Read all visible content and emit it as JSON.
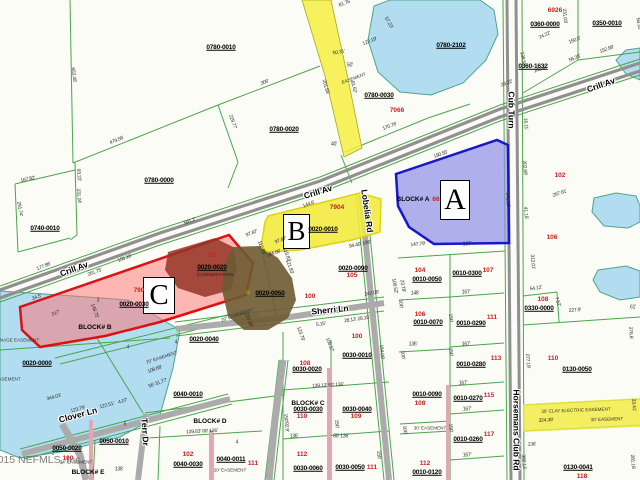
{
  "map": {
    "watermark": "©2015 NEFMLS, Inc",
    "regions": [
      {
        "letter": "A",
        "fill": "#8f8fe8",
        "border": "#1717cc"
      },
      {
        "letter": "B",
        "fill": "#f1ea3c",
        "border": "#ddd312"
      },
      {
        "letter": "C",
        "fill": "#ff7070",
        "border": "#dd1111"
      }
    ],
    "labels": {
      "parcels": [
        {
          "t": "0780-0010",
          "x": 221,
          "y": 48
        },
        {
          "t": "0780-0020",
          "x": 284,
          "y": 130
        },
        {
          "t": "0780-0000",
          "x": 159,
          "y": 181
        },
        {
          "t": "0740-0010",
          "x": 45,
          "y": 229
        },
        {
          "t": "0780-2102",
          "x": 451,
          "y": 46
        },
        {
          "t": "0360-0000",
          "x": 545,
          "y": 25
        },
        {
          "t": "0350-0010",
          "x": 607,
          "y": 24
        },
        {
          "t": "0360-1632",
          "x": 533,
          "y": 67
        },
        {
          "t": "0780-0030",
          "x": 379,
          "y": 96
        },
        {
          "t": "0020-0010",
          "x": 323,
          "y": 230
        },
        {
          "t": "0020-0020",
          "x": 212,
          "y": 268
        },
        {
          "t": "0020-0030",
          "x": 134,
          "y": 305
        },
        {
          "t": "0020-0040",
          "x": 204,
          "y": 340
        },
        {
          "t": "0020-0050",
          "x": 270,
          "y": 294
        },
        {
          "t": "0020-0090",
          "x": 353,
          "y": 269
        },
        {
          "t": "0020-0000",
          "x": 37,
          "y": 364
        },
        {
          "t": "0010-0050",
          "x": 427,
          "y": 280
        },
        {
          "t": "0010-0300",
          "x": 467,
          "y": 274
        },
        {
          "t": "0010-0070",
          "x": 428,
          "y": 323
        },
        {
          "t": "0010-0290",
          "x": 471,
          "y": 324
        },
        {
          "t": "0010-0280",
          "x": 471,
          "y": 365
        },
        {
          "t": "0010-0270",
          "x": 468,
          "y": 399
        },
        {
          "t": "0010-0090",
          "x": 427,
          "y": 395
        },
        {
          "t": "0010-0260",
          "x": 468,
          "y": 440
        },
        {
          "t": "0010-0120",
          "x": 427,
          "y": 473
        },
        {
          "t": "0130-0050",
          "x": 577,
          "y": 370
        },
        {
          "t": "0130-0041",
          "x": 578,
          "y": 468
        },
        {
          "t": "0330-0000",
          "x": 539,
          "y": 309
        },
        {
          "t": "0030-0010",
          "x": 357,
          "y": 356
        },
        {
          "t": "0030-0020",
          "x": 307,
          "y": 370
        },
        {
          "t": "0030-0030",
          "x": 308,
          "y": 410
        },
        {
          "t": "0030-0040",
          "x": 357,
          "y": 410
        },
        {
          "t": "0030-0060",
          "x": 308,
          "y": 469
        },
        {
          "t": "0030-0050",
          "x": 350,
          "y": 468
        },
        {
          "t": "0040-0010",
          "x": 188,
          "y": 395
        },
        {
          "t": "0040-0030",
          "x": 188,
          "y": 465
        },
        {
          "t": "0040-0011",
          "x": 231,
          "y": 460
        },
        {
          "t": "0050-0020",
          "x": 67,
          "y": 449
        },
        {
          "t": "0050-0010",
          "x": 114,
          "y": 442
        }
      ],
      "lot_numbers": [
        {
          "t": "6926",
          "x": 555,
          "y": 11
        },
        {
          "t": "7066",
          "x": 397,
          "y": 111
        },
        {
          "t": "7904",
          "x": 337,
          "y": 208
        },
        {
          "t": "790",
          "x": 139,
          "y": 291
        },
        {
          "t": "50",
          "x": 212,
          "y": 256
        },
        {
          "t": "66",
          "x": 436,
          "y": 200
        },
        {
          "t": "102",
          "x": 560,
          "y": 176
        },
        {
          "t": "106",
          "x": 552,
          "y": 238
        },
        {
          "t": "104",
          "x": 420,
          "y": 271
        },
        {
          "t": "107",
          "x": 488,
          "y": 271
        },
        {
          "t": "105",
          "x": 352,
          "y": 276
        },
        {
          "t": "100",
          "x": 310,
          "y": 297
        },
        {
          "t": "100",
          "x": 357,
          "y": 337
        },
        {
          "t": "108",
          "x": 305,
          "y": 364
        },
        {
          "t": "106",
          "x": 420,
          "y": 315
        },
        {
          "t": "111",
          "x": 492,
          "y": 318
        },
        {
          "t": "113",
          "x": 496,
          "y": 359
        },
        {
          "t": "110",
          "x": 553,
          "y": 359
        },
        {
          "t": "108",
          "x": 543,
          "y": 300
        },
        {
          "t": "115",
          "x": 489,
          "y": 396
        },
        {
          "t": "108",
          "x": 420,
          "y": 404
        },
        {
          "t": "117",
          "x": 489,
          "y": 435
        },
        {
          "t": "112",
          "x": 425,
          "y": 464
        },
        {
          "t": "118",
          "x": 582,
          "y": 477
        },
        {
          "t": "110",
          "x": 302,
          "y": 417
        },
        {
          "t": "109",
          "x": 356,
          "y": 417
        },
        {
          "t": "112",
          "x": 302,
          "y": 455
        },
        {
          "t": "111",
          "x": 372,
          "y": 468
        },
        {
          "t": "102",
          "x": 188,
          "y": 455
        },
        {
          "t": "111",
          "x": 253,
          "y": 464
        },
        {
          "t": "100",
          "x": 68,
          "y": 459
        }
      ],
      "roads": [
        {
          "t": "Crill Av",
          "x": 74,
          "y": 269,
          "r": -20
        },
        {
          "t": "Crill Av",
          "x": 318,
          "y": 192,
          "r": -17
        },
        {
          "t": "Crill Av",
          "x": 601,
          "y": 85,
          "r": -19
        },
        {
          "t": "Cub Turn",
          "x": 511,
          "y": 110,
          "r": 90
        },
        {
          "t": "Horsemans Club Rd",
          "x": 516,
          "y": 430,
          "r": 90
        },
        {
          "t": "Lobelia Rd",
          "x": 367,
          "y": 211,
          "r": 82
        },
        {
          "t": "Sherri Ln",
          "x": 330,
          "y": 310,
          "r": -6
        },
        {
          "t": "Clover Ln",
          "x": 78,
          "y": 415,
          "r": -15
        },
        {
          "t": "Terr Dr",
          "x": 145,
          "y": 432,
          "r": 87
        }
      ],
      "blocks": [
        {
          "t": "BLOCK# A",
          "x": 413,
          "y": 200
        },
        {
          "t": "BLOCK# B",
          "x": 95,
          "y": 328
        },
        {
          "t": "BLOCK# C",
          "x": 308,
          "y": 404
        },
        {
          "t": "BLOCK# D",
          "x": 210,
          "y": 422
        },
        {
          "t": "BLOCK# E",
          "x": 88,
          "y": 473
        }
      ],
      "easements": [
        {
          "t": "DRAINAGE EASEMENT",
          "x": 14,
          "y": 341
        },
        {
          "t": "EASEMENT",
          "x": 8,
          "y": 380
        },
        {
          "t": "EASEMENT",
          "x": 354,
          "y": 79,
          "r": -20
        },
        {
          "t": "20' EASEMENT",
          "x": 237,
          "y": 316,
          "r": -18
        },
        {
          "t": "20' EASEMENT",
          "x": 162,
          "y": 358,
          "r": -18
        },
        {
          "t": "20' EASEMENT",
          "x": 230,
          "y": 471
        },
        {
          "t": "24' EASEMENT",
          "x": 76,
          "y": 463
        },
        {
          "t": "30' EASEMENT",
          "x": 430,
          "y": 429
        },
        {
          "t": "30' CLAY ELECTRIC EASEMENT",
          "x": 576,
          "y": 411,
          "r": -2
        },
        {
          "t": "30' EASEMENT",
          "x": 607,
          "y": 420,
          "r": -2
        }
      ],
      "notes": [
        {
          "t": "(CONSERVATION",
          "x": 215,
          "y": 275
        }
      ],
      "numbers": [
        {
          "t": "3",
          "x": 98,
          "y": 301
        },
        {
          "t": "4",
          "x": 128,
          "y": 348
        },
        {
          "t": "4",
          "x": 176,
          "y": 343
        },
        {
          "t": "4",
          "x": 237,
          "y": 443
        },
        {
          "t": "2",
          "x": 53,
          "y": 454
        },
        {
          "t": "5",
          "x": 125,
          "y": 425
        }
      ],
      "markers": [
        {
          "t": "⊕",
          "x": 248,
          "y": 293
        }
      ],
      "dimensions": [
        {
          "t": "653.48'",
          "x": 73,
          "y": 75,
          "r": 83
        },
        {
          "t": "81.76'",
          "x": 345,
          "y": 4,
          "r": -20
        },
        {
          "t": "479.56'",
          "x": 117,
          "y": 141,
          "r": -22
        },
        {
          "t": "306'",
          "x": 265,
          "y": 83,
          "r": -21
        },
        {
          "t": "229.77'",
          "x": 232,
          "y": 122,
          "r": 70
        },
        {
          "t": "167.82'",
          "x": 28,
          "y": 180,
          "r": -12
        },
        {
          "t": "291.74'",
          "x": 19,
          "y": 209,
          "r": 80
        },
        {
          "t": "93.22'",
          "x": 78,
          "y": 175,
          "r": 85
        },
        {
          "t": "231.24'",
          "x": 78,
          "y": 196,
          "r": 85
        },
        {
          "t": "177.86'",
          "x": 44,
          "y": 267,
          "r": -22
        },
        {
          "t": "581.2'",
          "x": 190,
          "y": 222,
          "r": -21
        },
        {
          "t": "156.16'",
          "x": 125,
          "y": 259,
          "r": -21
        },
        {
          "t": "122.19'",
          "x": 370,
          "y": 42,
          "r": -22
        },
        {
          "t": "50.31'",
          "x": 339,
          "y": 53,
          "r": -10
        },
        {
          "t": "50'",
          "x": 350,
          "y": 66
        },
        {
          "t": "57.23'",
          "x": 388,
          "y": 23,
          "r": 60
        },
        {
          "t": "201.55'",
          "x": 325,
          "y": 87,
          "r": 75
        },
        {
          "t": "81.62'",
          "x": 353,
          "y": 87,
          "r": 75
        },
        {
          "t": "170.76'",
          "x": 390,
          "y": 127,
          "r": -21
        },
        {
          "t": "40'",
          "x": 334,
          "y": 145
        },
        {
          "t": "231.03'",
          "x": 564,
          "y": 16,
          "r": 85
        },
        {
          "t": "24.22'",
          "x": 545,
          "y": 36,
          "r": -25
        },
        {
          "t": "150.6'",
          "x": 575,
          "y": 41,
          "r": -22
        },
        {
          "t": "56.25'",
          "x": 575,
          "y": 59,
          "r": -22
        },
        {
          "t": "142.4'",
          "x": 540,
          "y": 70,
          "r": -21
        },
        {
          "t": "138.5'",
          "x": 522,
          "y": 58,
          "r": 80
        },
        {
          "t": "152.98'",
          "x": 607,
          "y": 50,
          "r": -20
        },
        {
          "t": "58.35'",
          "x": 638,
          "y": 24,
          "r": 80
        },
        {
          "t": "23.22'",
          "x": 507,
          "y": 84,
          "r": -20
        },
        {
          "t": "16.11'",
          "x": 525,
          "y": 124,
          "r": 85
        },
        {
          "t": "190.55'",
          "x": 441,
          "y": 155,
          "r": -20
        },
        {
          "t": "144.6'",
          "x": 309,
          "y": 205,
          "r": -20
        },
        {
          "t": "97.87'",
          "x": 252,
          "y": 234,
          "r": -20
        },
        {
          "t": "97.87'",
          "x": 281,
          "y": 241,
          "r": -20
        },
        {
          "t": "115.82'",
          "x": 286,
          "y": 255,
          "r": 70
        },
        {
          "t": "112.85'",
          "x": 261,
          "y": 248,
          "r": 70
        },
        {
          "t": "184.66'",
          "x": 274,
          "y": 254,
          "r": -20
        },
        {
          "t": "121.83'",
          "x": 289,
          "y": 267,
          "r": 70
        },
        {
          "t": "94.40'  106'",
          "x": 360,
          "y": 245,
          "r": -12
        },
        {
          "t": "147.79'",
          "x": 418,
          "y": 245,
          "r": -5
        },
        {
          "t": "167'",
          "x": 467,
          "y": 245
        },
        {
          "t": "241.18'",
          "x": 507,
          "y": 200,
          "r": 85
        },
        {
          "t": "41.15'",
          "x": 525,
          "y": 213,
          "r": 85
        },
        {
          "t": "202.69'",
          "x": 524,
          "y": 168,
          "r": 85
        },
        {
          "t": "267.61'",
          "x": 560,
          "y": 194,
          "r": -20
        },
        {
          "t": "106.52'",
          "x": 394,
          "y": 286,
          "r": 80
        },
        {
          "t": "23.78'",
          "x": 402,
          "y": 286,
          "r": 80
        },
        {
          "t": "261.75'",
          "x": 95,
          "y": 273,
          "r": -20
        },
        {
          "t": "148.75'",
          "x": 94,
          "y": 311,
          "r": 70
        },
        {
          "t": "34.5'",
          "x": 37,
          "y": 298,
          "r": -20
        },
        {
          "t": "317'",
          "x": 56,
          "y": 314,
          "r": -20
        },
        {
          "t": "210.38'",
          "x": 248,
          "y": 320,
          "r": 70
        },
        {
          "t": "344.03'",
          "x": 54,
          "y": 398,
          "r": -15
        },
        {
          "t": "123.79'",
          "x": 78,
          "y": 410,
          "r": -15
        },
        {
          "t": "122.51'",
          "x": 107,
          "y": 406,
          "r": -15
        },
        {
          "t": "4.07'",
          "x": 123,
          "y": 402,
          "r": -15
        },
        {
          "t": "108.68'",
          "x": 155,
          "y": 370,
          "r": -20
        },
        {
          "t": "56' 31.77'",
          "x": 158,
          "y": 384,
          "r": -20
        },
        {
          "t": "139.83' 80' 136'",
          "x": 202,
          "y": 432,
          "r": -3
        },
        {
          "t": "136'",
          "x": 119,
          "y": 470
        },
        {
          "t": "242.06'",
          "x": 372,
          "y": 294,
          "r": -10
        },
        {
          "t": "28.13' 28.15'",
          "x": 357,
          "y": 320,
          "r": -8
        },
        {
          "t": "5.15'",
          "x": 321,
          "y": 325,
          "r": -8
        },
        {
          "t": "123.79'",
          "x": 300,
          "y": 334,
          "r": 70
        },
        {
          "t": "106.57'",
          "x": 329,
          "y": 345,
          "r": 70
        },
        {
          "t": "154.09'",
          "x": 381,
          "y": 352,
          "r": 85
        },
        {
          "t": "139.13' 80' 136'",
          "x": 328,
          "y": 386,
          "r": -3
        },
        {
          "t": "136'",
          "x": 294,
          "y": 437
        },
        {
          "t": "80' 136'",
          "x": 341,
          "y": 437
        },
        {
          "t": "150'",
          "x": 285,
          "y": 418,
          "r": 85
        },
        {
          "t": "150'",
          "x": 336,
          "y": 424,
          "r": 85
        },
        {
          "t": "150'",
          "x": 378,
          "y": 455,
          "r": 85
        },
        {
          "t": "146'",
          "x": 415,
          "y": 294
        },
        {
          "t": "167'",
          "x": 466,
          "y": 293
        },
        {
          "t": "136'",
          "x": 413,
          "y": 345
        },
        {
          "t": "167'",
          "x": 466,
          "y": 345
        },
        {
          "t": "167'",
          "x": 463,
          "y": 384
        },
        {
          "t": "167'",
          "x": 467,
          "y": 410
        },
        {
          "t": "167'",
          "x": 467,
          "y": 456
        },
        {
          "t": "150'",
          "x": 450,
          "y": 318,
          "r": 85
        },
        {
          "t": "150'",
          "x": 450,
          "y": 352,
          "r": 85
        },
        {
          "t": "150'",
          "x": 450,
          "y": 428,
          "r": 85
        },
        {
          "t": "100'",
          "x": 400,
          "y": 304,
          "r": 85
        },
        {
          "t": "100'",
          "x": 402,
          "y": 355,
          "r": 85
        },
        {
          "t": "100'",
          "x": 404,
          "y": 430,
          "r": 85
        },
        {
          "t": "54.12'",
          "x": 536,
          "y": 289,
          "r": -8
        },
        {
          "t": "227.9'",
          "x": 575,
          "y": 311,
          "r": -5
        },
        {
          "t": "7.52'",
          "x": 557,
          "y": 302,
          "r": 70
        },
        {
          "t": "61'",
          "x": 633,
          "y": 308
        },
        {
          "t": "276.6'",
          "x": 630,
          "y": 333,
          "r": 85
        },
        {
          "t": "277.19'",
          "x": 527,
          "y": 361,
          "r": 85
        },
        {
          "t": "312.01'",
          "x": 532,
          "y": 262,
          "r": 85
        },
        {
          "t": "382.12'",
          "x": 523,
          "y": 462,
          "r": 85
        },
        {
          "t": "281.16'",
          "x": 632,
          "y": 462,
          "r": 85
        },
        {
          "t": "33.41'",
          "x": 633,
          "y": 405,
          "r": 85
        },
        {
          "t": "324.38'",
          "x": 546,
          "y": 421,
          "r": -3
        },
        {
          "t": "92.9'",
          "x": 286,
          "y": 427,
          "r": 85
        },
        {
          "t": "136'",
          "x": 532,
          "y": 445,
          "r": -3
        }
      ]
    }
  }
}
